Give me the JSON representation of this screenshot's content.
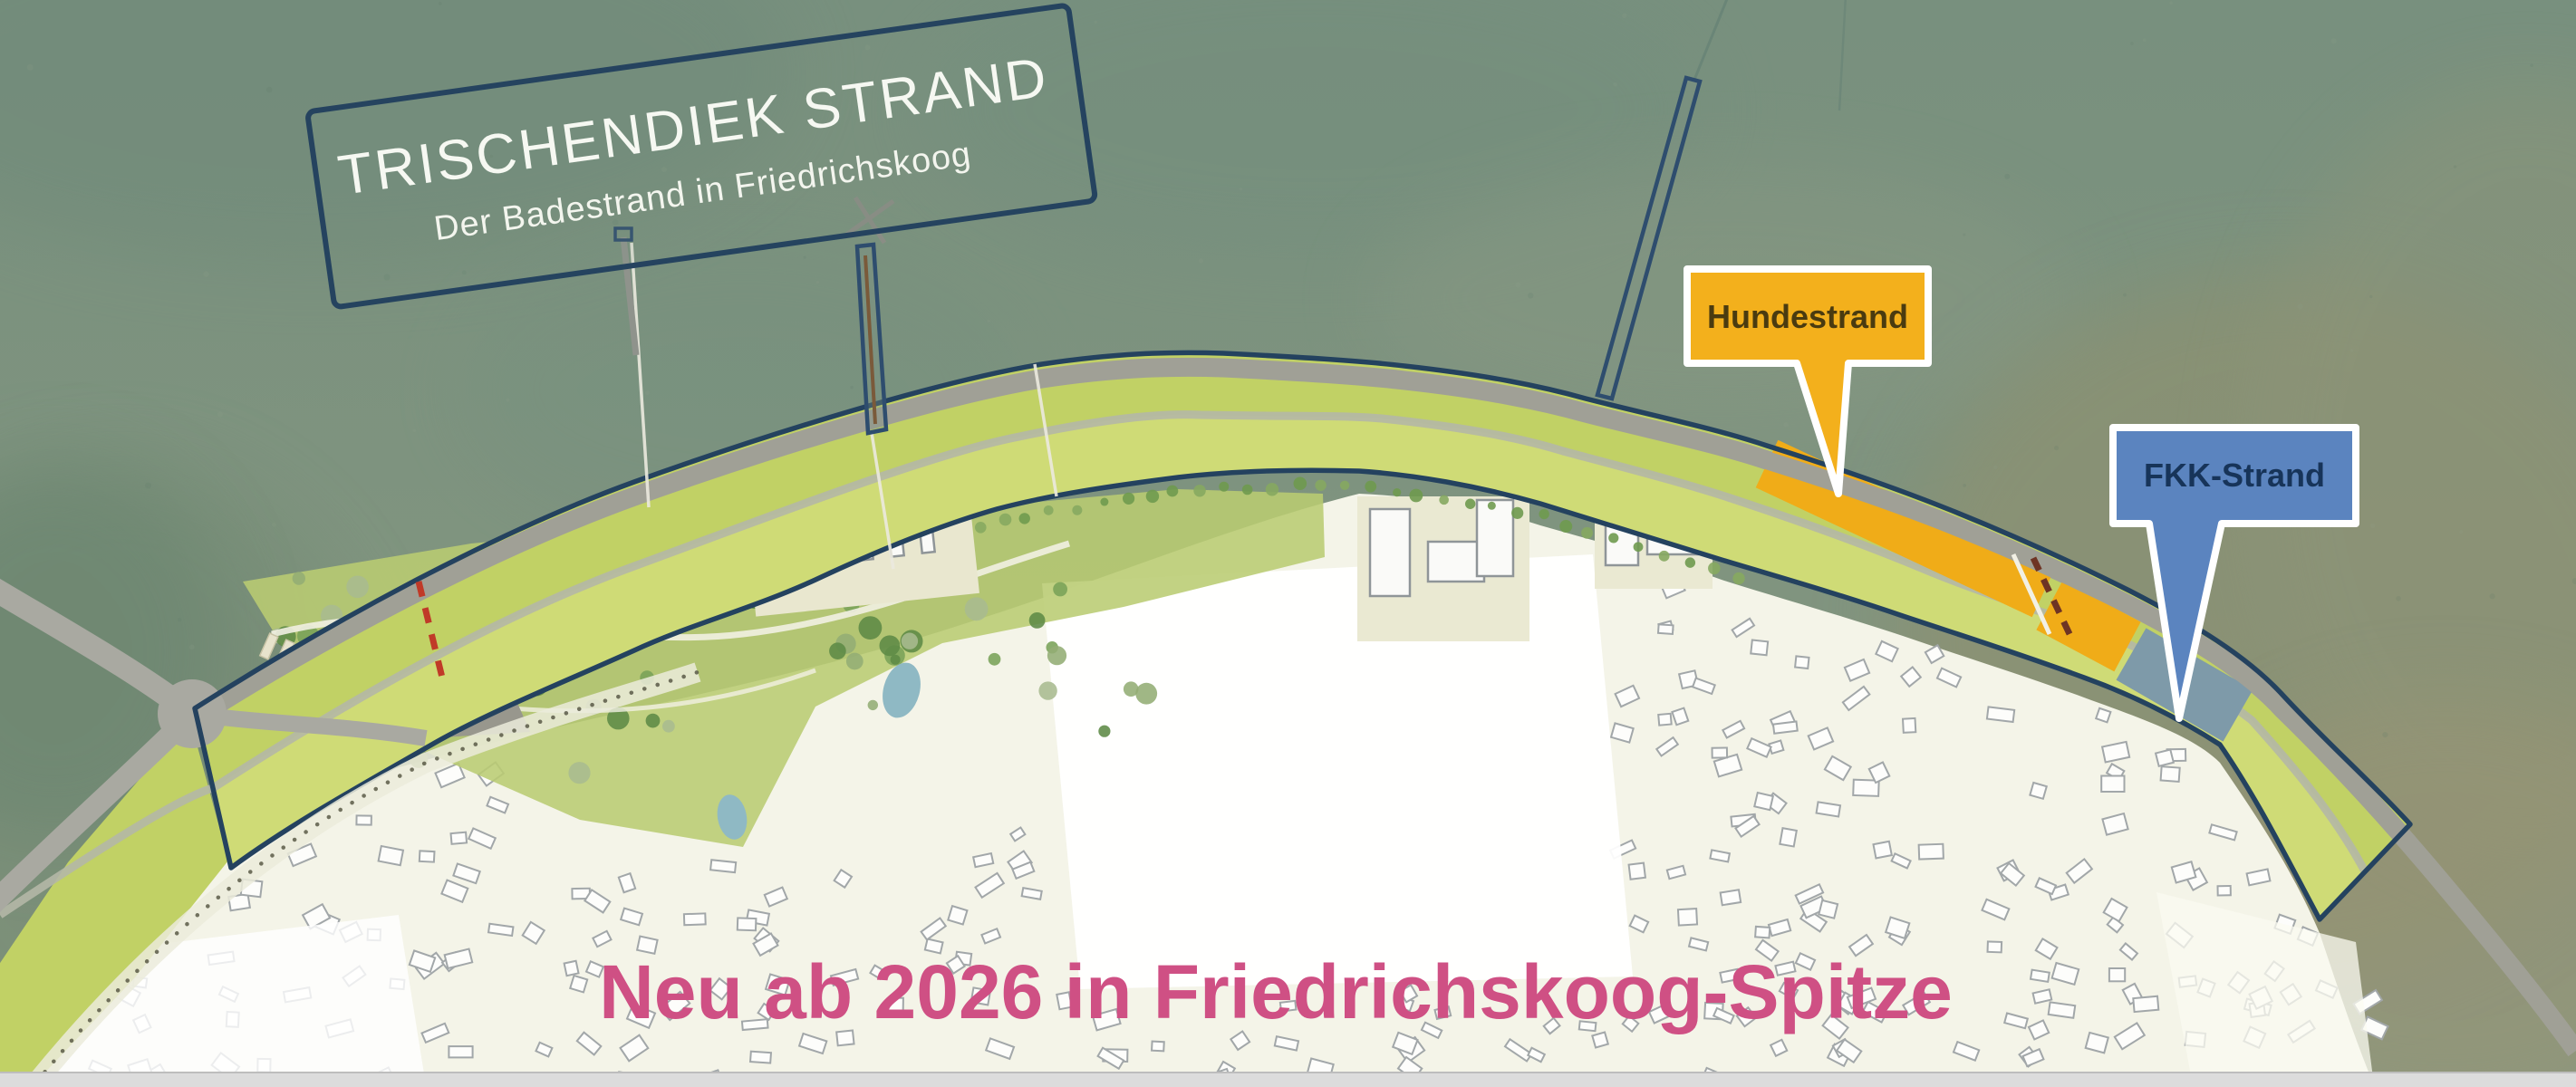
{
  "title_plate": {
    "line1": "TRISCHENDIEK STRAND",
    "line2": "Der Badestrand in Friedrichskoog"
  },
  "flags": {
    "dog_beach_label": "Hundestrand",
    "nudist_beach_label": "FKK-Strand"
  },
  "headline": {
    "text": "Neu ab 2026 in Friedrichskoog-Spitze",
    "color": "#cf5084"
  },
  "map_regions": {
    "sea": "Wattenmeer / Nordsee",
    "dike": "Trischendiek mit Deichverteidigungsweg",
    "town": "Friedrichskoog-Spitze Ortslage",
    "dog_beach_zone": "Hundestrand-Bereich",
    "nudist_beach_zone": "FKK-Strand-Bereich",
    "park": "Badestrand-Gruenanlage"
  },
  "colors": {
    "sea": "#7a9181",
    "sea_deep": "#6d8878",
    "marsh_brown": "#93906c",
    "dike_green": "#c1d165",
    "dike_green_light": "#d3de7c",
    "road_gray": "#a0a096",
    "boundary_navy": "#24425f",
    "town_ivory": "#f4f4e8",
    "house_stroke": "#a2a7a9",
    "flag_amber": "#f3b01c",
    "flag_blue": "#5b84bf",
    "flag_amber_text": "#4a3b10",
    "flag_blue_text": "#173459",
    "beach_orange": "#f0ac18",
    "beach_slate": "#7e9aa9",
    "dash_red": "#c03a28",
    "headline_pink": "#cf5084",
    "bottom_bar": "#dcdcdc"
  },
  "decor": {
    "seed": 7,
    "house_count": 250,
    "sea_speckles": 150,
    "park_trees": 48
  }
}
